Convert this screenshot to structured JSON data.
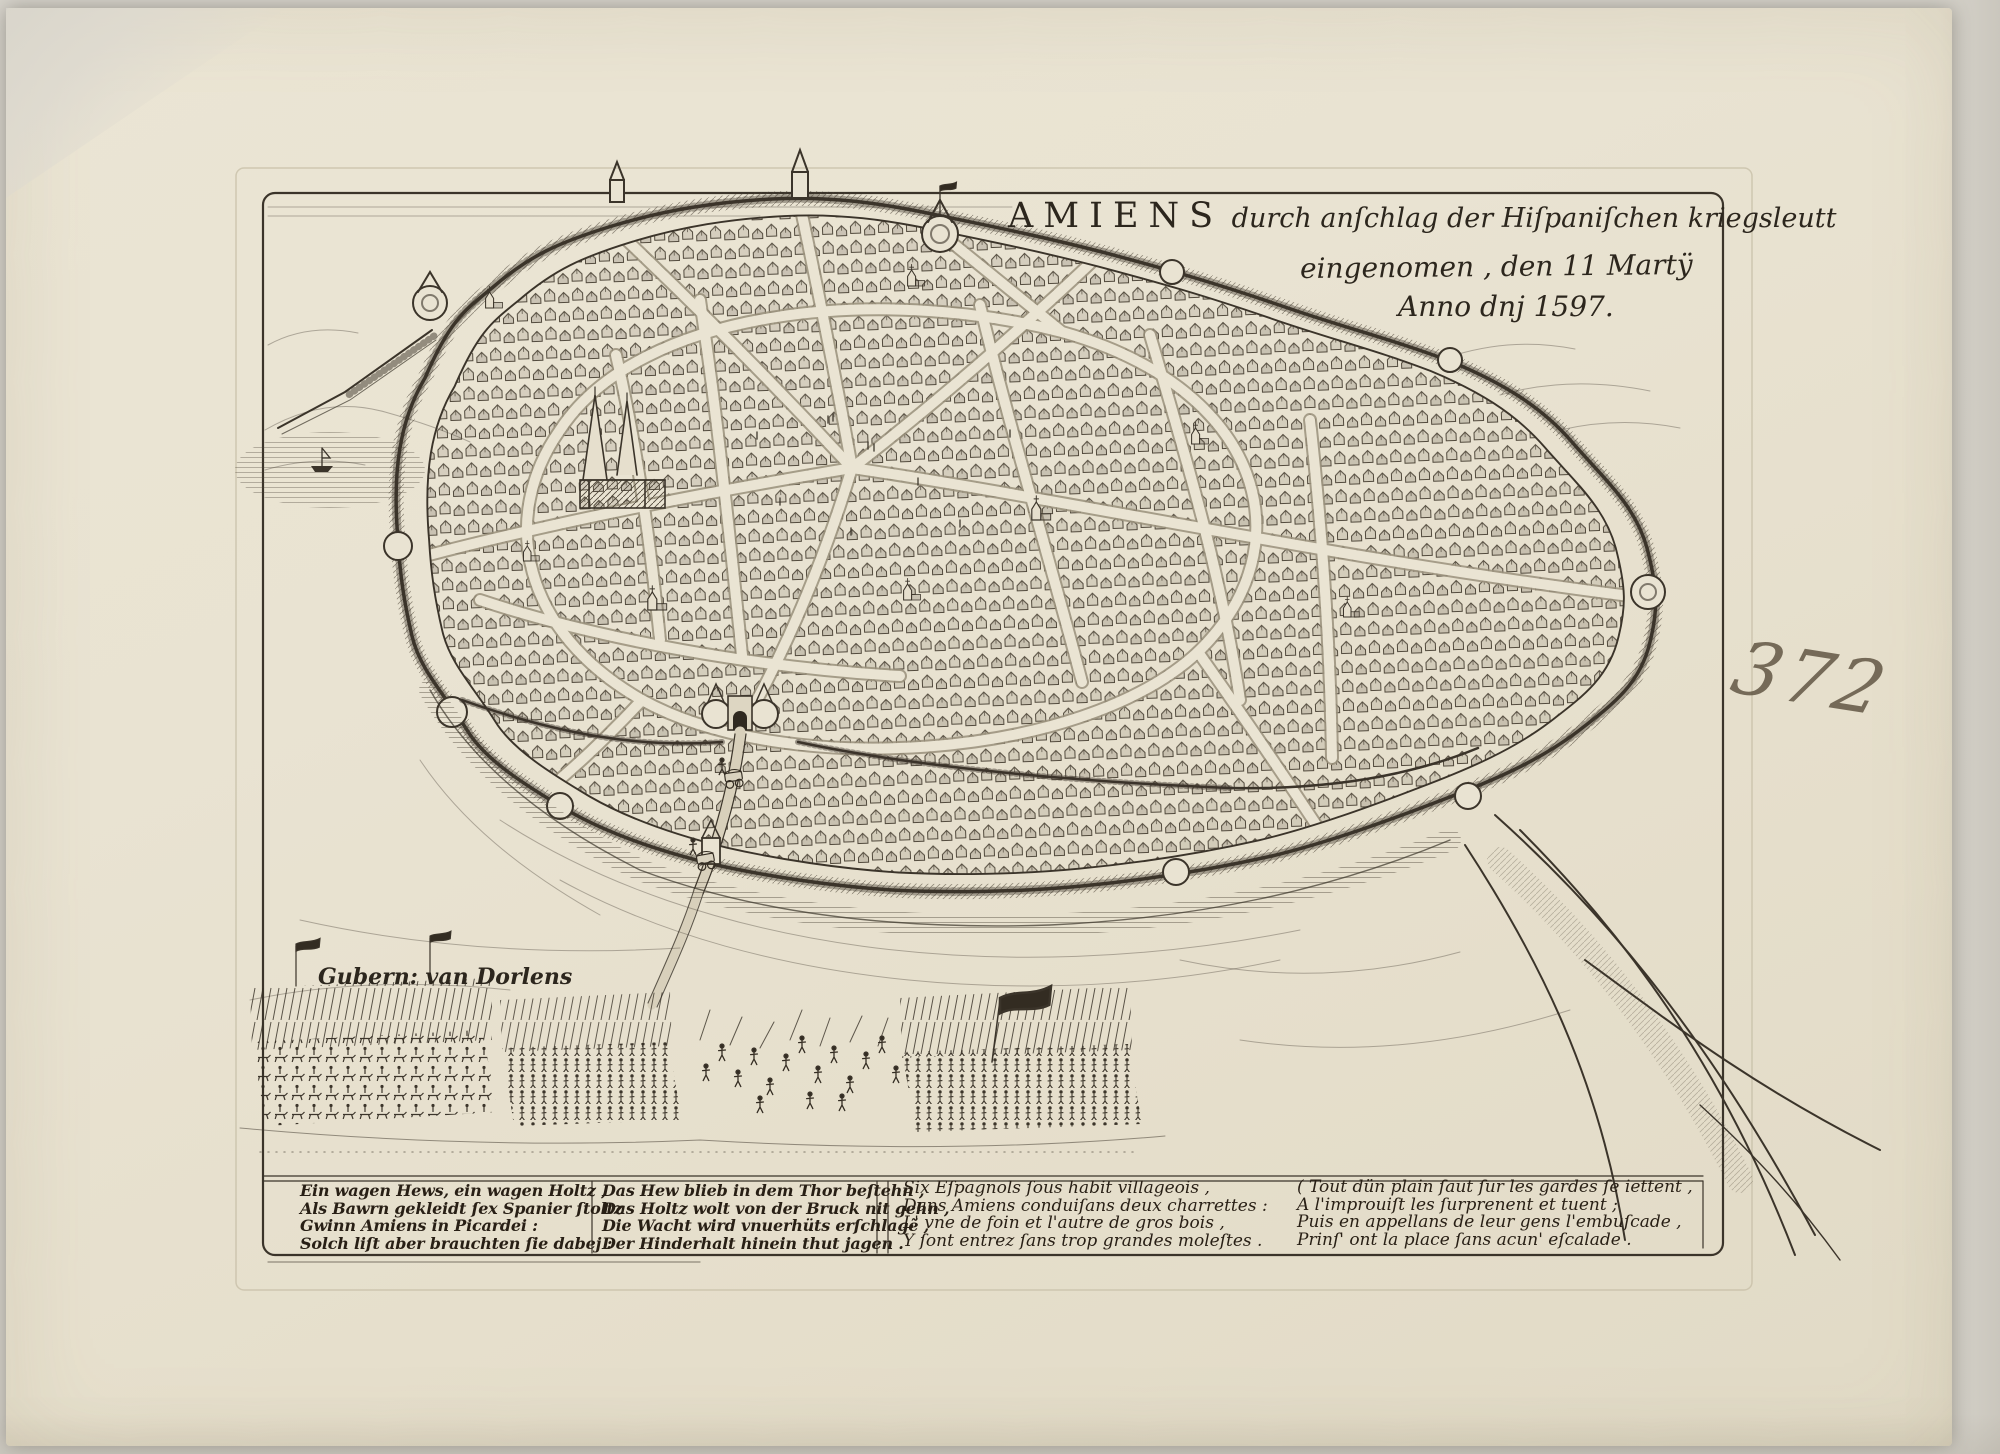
{
  "print": {
    "title": {
      "city": "AMIENS",
      "line1_rest": " durch anſchlag der Hiſpaniſchen kriegsleutt",
      "line2": "eingenomen , den 11 Martÿ",
      "line3": "Anno dnj 1597."
    },
    "governor_label": "Gubern: van Dorlens",
    "handwritten_number": "372",
    "captions": {
      "german_1": [
        "Ein wagen Hews, ein wagen Holtz ,",
        "Als Bawrn gekleidt ſex Spanier ſtoltz",
        "Gwinn Amiens in Picardei :",
        "Solch liſt aber brauchten ſie dabej :"
      ],
      "german_2": [
        "Das Hew blieb in dem Thor beſtehn ,",
        "Das Holtz wolt von der Bruck nit gehn ,",
        "Die Wacht wird vnuerhüts erſchlagẽ ,",
        "Der Hinderhalt hinein thut jagen ."
      ],
      "french_1": [
        "Six Eſpagnols ſous habit villageois ,",
        "Dans Amiens conduiſans deux charrettes :",
        "L' vne de foin et l'autre de gros bois ,",
        "Y ſont entrez ſans trop grandes moleſtes ."
      ],
      "french_2": [
        "( Tout dün plain ſaut ſur les gardes ſe iettent ,",
        "A l'improuiſt les ſurprenent et tuent ;",
        "Puis en appellans de leur gens l'embuſcade ,",
        "Prinſ' ont la place ſans acun' eſcalade ."
      ]
    },
    "colors": {
      "ink": "#342d23",
      "paper": "#e9e3d1"
    }
  }
}
